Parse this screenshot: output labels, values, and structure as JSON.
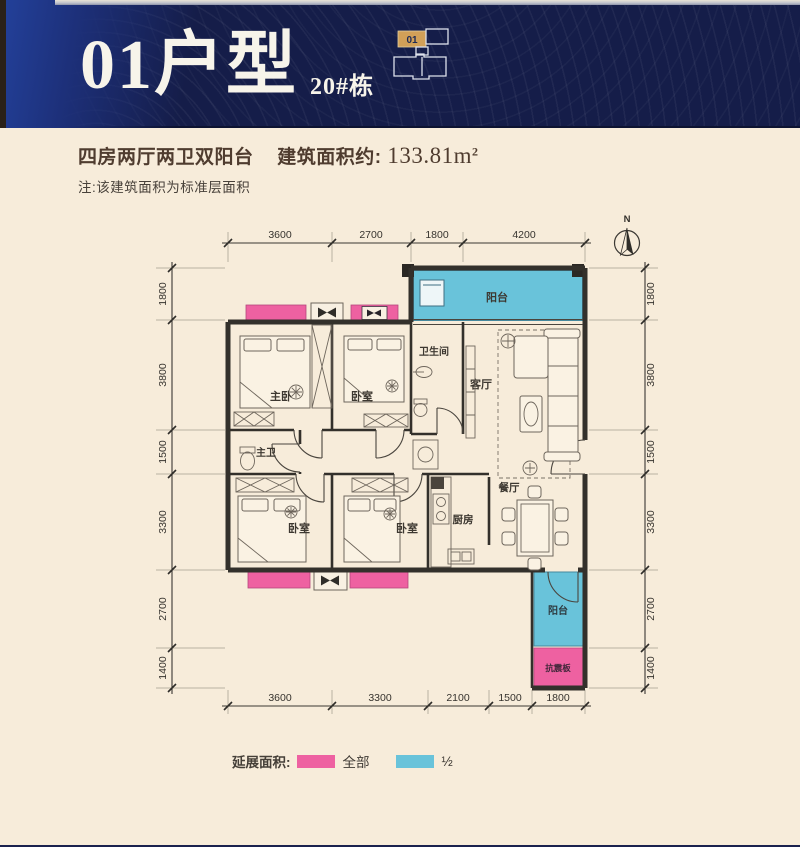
{
  "header": {
    "unit_type": "01户型",
    "building": "20#栋",
    "keyplan_unit": "01"
  },
  "summary": {
    "headline": "四房两厅两卫双阳台",
    "area_label": "建筑面积约:",
    "area_value": "133.81m",
    "area_exponent": "2",
    "note": "注:该建筑面积为标准层面积"
  },
  "compass": {
    "north_label": "N"
  },
  "dimensions": {
    "top": [
      "3600",
      "2700",
      "1800",
      "4200"
    ],
    "bottom": [
      "3600",
      "3300",
      "2100",
      "1500",
      "1800"
    ],
    "left": [
      "1800",
      "3800",
      "1500",
      "3300",
      "2700",
      "1400"
    ],
    "right": [
      "1800",
      "3800",
      "1500",
      "3300",
      "2700",
      "1400"
    ]
  },
  "rooms": {
    "balcony_top": "阳台",
    "bathroom": "卫生间",
    "living": "客厅",
    "master_bedroom": "主卧",
    "bedroom_top": "卧室",
    "master_bath": "主卫",
    "bedroom_left": "卧室",
    "bedroom_mid": "卧室",
    "kitchen": "厨房",
    "dining": "餐厅",
    "balcony_bottom": "阳台",
    "seismic_board": "抗震板"
  },
  "legend": {
    "title": "延展面积:",
    "full_label": "全部",
    "half_label": "½"
  },
  "colors": {
    "header_navy": "#151d49",
    "accent_blue": "#23419b",
    "background_cream": "#f7ecda",
    "bay_pink": "#ee61a1",
    "balcony_blue": "#69c3da",
    "wall_black": "#33302b",
    "title_brown": "#4f3c2f",
    "keyplan_orange": "#d2a058"
  }
}
